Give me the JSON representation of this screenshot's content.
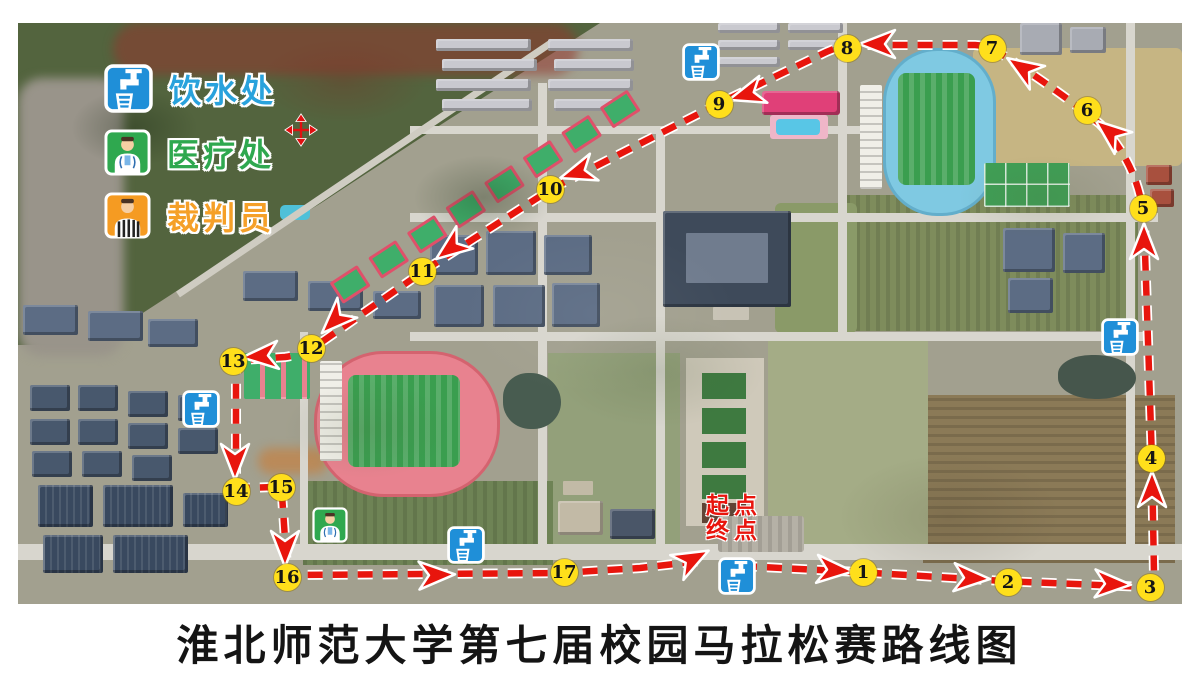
{
  "title": "淮北师范大学第七届校园马拉松赛路线图",
  "legend": {
    "items": [
      {
        "id": "water-station",
        "label": "饮水处",
        "color": "#29a2dc"
      },
      {
        "id": "medical-station",
        "label": "医疗处",
        "color": "#2fa84f"
      },
      {
        "id": "referee",
        "label": "裁判员",
        "color": "#f5a028"
      }
    ]
  },
  "start_finish": {
    "line1": "起点",
    "line2": "终点",
    "color": "#e8150d"
  },
  "route": {
    "color": "#e8150d",
    "marker_fill": "#ffdf1b",
    "path_d": "M742 566 L858 572 L1003 581 L1146 587 Q1155 585 1154 574 L1152 460 L1144 222 Q1140 166 1100 124 L1085 112 Q1040 78 998 52 Q990 46 975 45 L852 45 Q840 45 820 55 L722 102 L553 188 L425 270 L316 346 Q300 355 285 357 L243 360 Q236 361 236 370 L236 480 Q236 488 244 488 L274 487 Q282 487 282 495 L287 568 Q287 575 295 575 L560 573 L640 568 L700 561",
    "markers": [
      {
        "n": "1",
        "x": 863,
        "y": 572
      },
      {
        "n": "2",
        "x": 1008,
        "y": 582
      },
      {
        "n": "3",
        "x": 1150,
        "y": 587
      },
      {
        "n": "4",
        "x": 1151,
        "y": 458
      },
      {
        "n": "5",
        "x": 1143,
        "y": 208
      },
      {
        "n": "6",
        "x": 1087,
        "y": 110
      },
      {
        "n": "7",
        "x": 992,
        "y": 48
      },
      {
        "n": "8",
        "x": 847,
        "y": 48
      },
      {
        "n": "9",
        "x": 719,
        "y": 104
      },
      {
        "n": "10",
        "x": 550,
        "y": 189
      },
      {
        "n": "11",
        "x": 422,
        "y": 271
      },
      {
        "n": "12",
        "x": 311,
        "y": 348
      },
      {
        "n": "13",
        "x": 233,
        "y": 361
      },
      {
        "n": "14",
        "x": 236,
        "y": 491
      },
      {
        "n": "15",
        "x": 281,
        "y": 487
      },
      {
        "n": "16",
        "x": 287,
        "y": 577
      },
      {
        "n": "17",
        "x": 564,
        "y": 572
      }
    ],
    "arrows": [
      {
        "x": 833,
        "y": 570,
        "r": 4
      },
      {
        "x": 970,
        "y": 578,
        "r": 3
      },
      {
        "x": 1111,
        "y": 584,
        "r": 2
      },
      {
        "x": 1152,
        "y": 491,
        "r": -90
      },
      {
        "x": 1144,
        "y": 243,
        "r": -90
      },
      {
        "x": 1111,
        "y": 133,
        "r": -141
      },
      {
        "x": 1024,
        "y": 69,
        "r": -147
      },
      {
        "x": 879,
        "y": 44,
        "r": 180
      },
      {
        "x": 748,
        "y": 94,
        "r": 163
      },
      {
        "x": 579,
        "y": 172,
        "r": 162
      },
      {
        "x": 452,
        "y": 247,
        "r": 143
      },
      {
        "x": 336,
        "y": 319,
        "r": 135
      },
      {
        "x": 262,
        "y": 356,
        "r": 176
      },
      {
        "x": 235,
        "y": 460,
        "r": 90
      },
      {
        "x": 285,
        "y": 547,
        "r": 90
      },
      {
        "x": 435,
        "y": 575,
        "r": -2
      },
      {
        "x": 691,
        "y": 560,
        "r": -28
      }
    ]
  },
  "stations": {
    "water": [
      {
        "x": 701,
        "y": 62
      },
      {
        "x": 1120,
        "y": 337
      },
      {
        "x": 201,
        "y": 409
      },
      {
        "x": 466,
        "y": 545
      },
      {
        "x": 737,
        "y": 576
      }
    ],
    "medical": [
      {
        "x": 330,
        "y": 525
      }
    ]
  }
}
